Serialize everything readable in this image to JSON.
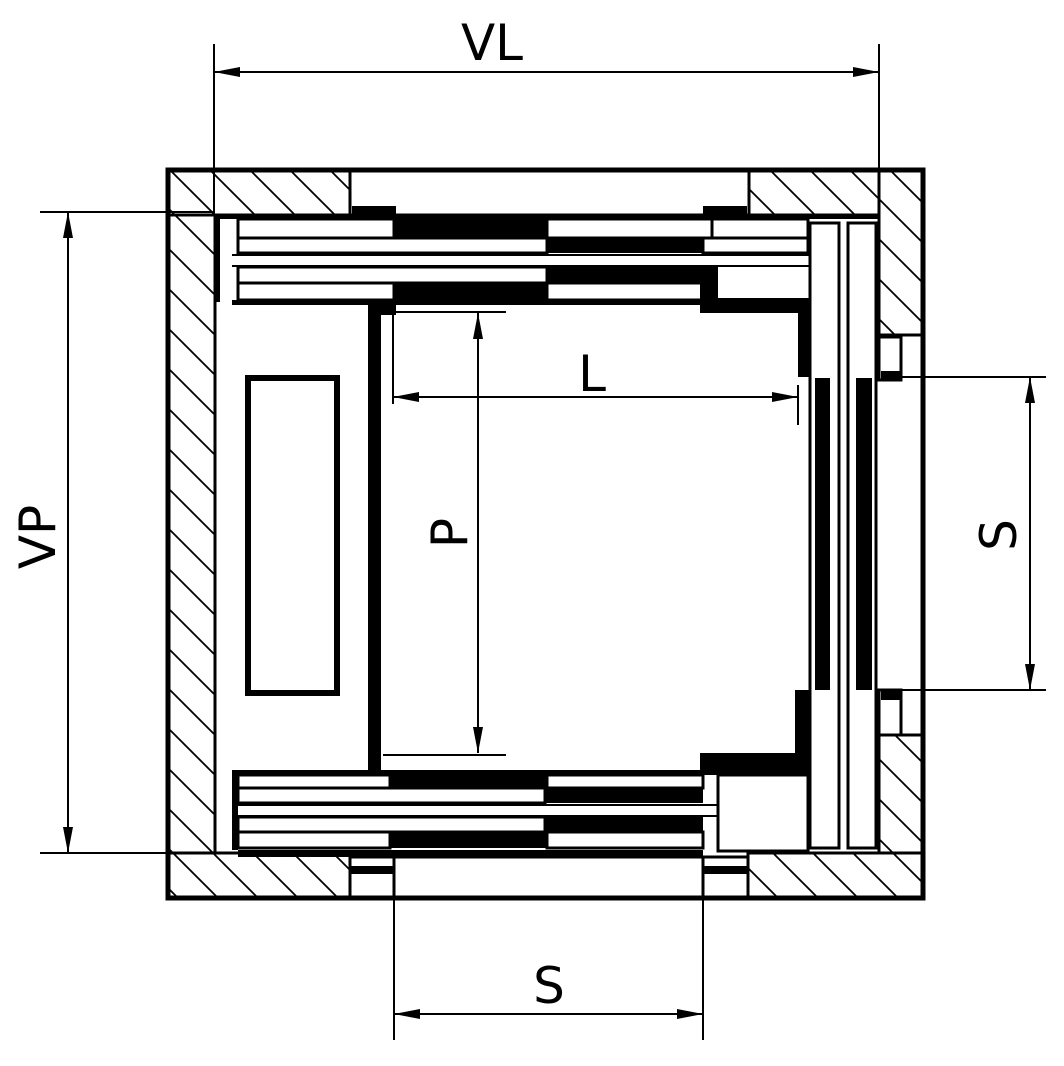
{
  "drawing": {
    "kind": "elevator-shaft-plan-section",
    "colors": {
      "ink": "#000000",
      "paper": "#ffffff"
    },
    "dimensions": {
      "shaft_width": {
        "label": "VL"
      },
      "shaft_depth": {
        "label": "VP"
      },
      "car_width": {
        "label": "L"
      },
      "car_depth": {
        "label": "P"
      },
      "door_opening_right": {
        "label": "S"
      },
      "door_opening_bottom": {
        "label": "S"
      }
    }
  }
}
